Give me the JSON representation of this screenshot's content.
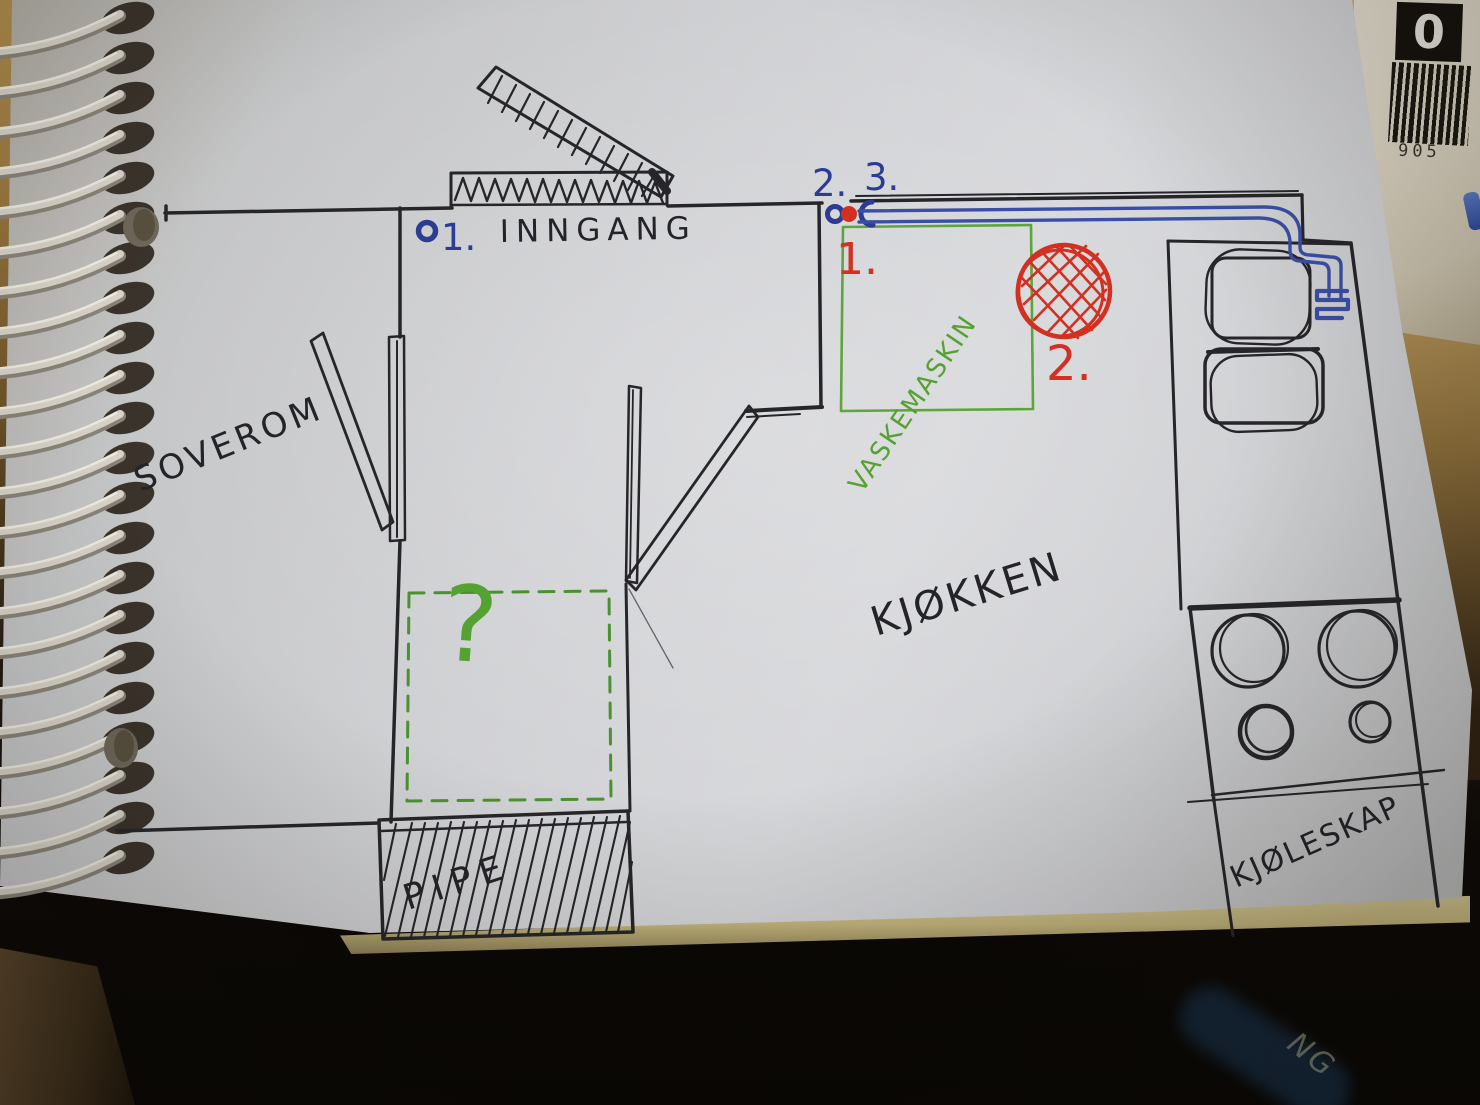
{
  "colors": {
    "ink_black": "#26262a",
    "ink_blue": "#2b3c92",
    "pipe_blue": "#3b4ea6",
    "ink_red": "#d23020",
    "ink_green": "#55a233",
    "paper": "#ced0d3",
    "desk_wood": "#a8854e",
    "page_stack_edge": "#cfc28b",
    "spiral_wire": "#d9d4c9"
  },
  "rooms": {
    "bedroom": "SOVEROM",
    "kitchen": "KJØKKEN",
    "entrance": "INNGANG",
    "chimney": "PIPE",
    "fridge": "KJØLESKAP",
    "washing_machine": "VASKEMASKIN",
    "unknown_area": "?"
  },
  "markers": {
    "blue_1": "1.",
    "blue_2": "2.",
    "blue_3": "3.",
    "red_1": "1.",
    "red_2": "2."
  },
  "barcode": {
    "corner_digit": "0",
    "number": "905"
  },
  "background": {
    "book_spine_text": "NG"
  }
}
